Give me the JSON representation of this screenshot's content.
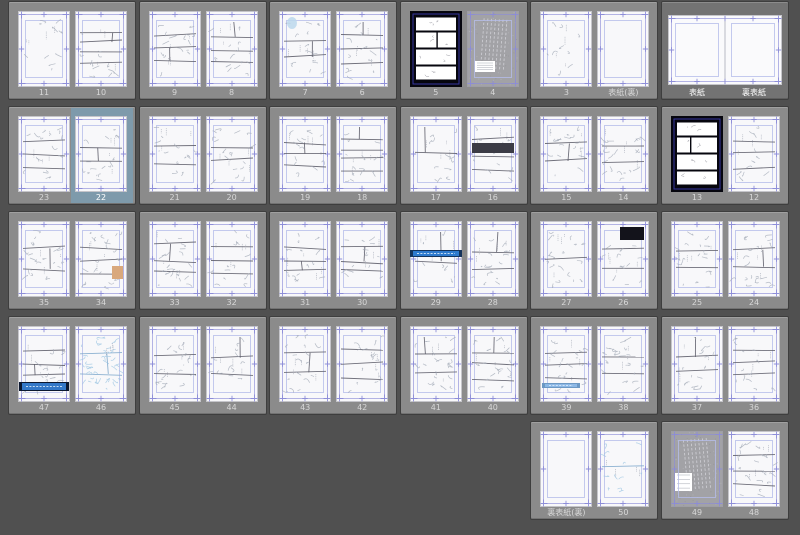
{
  "app": {
    "view_name": "page-manager-thumbnail-grid",
    "selected_page_label": "22",
    "selected_spread_labels": [
      "表紙",
      "裏表紙"
    ]
  },
  "palette": {
    "canvas_bg": "#505050",
    "group_bg": "#8b8b8b",
    "group_selected_bg": "#737373",
    "page_bg": "#f8f8fa",
    "black_page": "#06060e",
    "texture_bg": "#a2a2a6",
    "highlight_blue": "#7e9aab",
    "guide_blue": "#8c8cd8",
    "guide_light": "#b6bdea",
    "guide_dark_blue": "#3b3bb0",
    "sketch_gray": "#a4abb8",
    "sketch_blue": "#9cc6e2",
    "panel_line": "#5f5f6b",
    "label_color": "#d8d8d8",
    "label_selected": "#ffffff"
  },
  "features": {
    "blue-oval": {
      "kind": "ellipse",
      "cx": 13,
      "cy": 12,
      "rx": 5,
      "ry": 6,
      "fill": "#bcd8ec"
    },
    "dark-band": {
      "kind": "rect",
      "x": 5,
      "y": 27,
      "w": 42,
      "h": 10,
      "fill": "#3c3c46"
    },
    "orange-patch": {
      "kind": "rect",
      "x": 37,
      "y": 45,
      "w": 11,
      "h": 13,
      "fill": "#d9a87c"
    },
    "black-panel-tr": {
      "kind": "rect",
      "x": 23,
      "y": 6,
      "w": 24,
      "h": 13,
      "fill": "#13131b"
    },
    "banner-mid-blue": {
      "kind": "bar",
      "x": 0,
      "y": 29,
      "w": 52,
      "h": 7,
      "fill": "#2e7ace",
      "ends": "#14335c"
    },
    "banner-bottom-navy": {
      "kind": "bar",
      "x": 1,
      "y": 56,
      "w": 50,
      "h": 9,
      "fill": "#3478c8",
      "ends": "#0c1830"
    },
    "banner-bottom-light": {
      "kind": "bar",
      "x": 2,
      "y": 57,
      "w": 38,
      "h": 5,
      "fill": "#8cb8e6",
      "ends": "#6c98c4"
    }
  },
  "rows": [
    {
      "start_col": 0,
      "spreads": [
        {
          "pages": [
            {
              "label": "11",
              "type": "sketch",
              "panels": 0,
              "strokes": 10
            },
            {
              "label": "10",
              "type": "sketch",
              "panels": 4
            }
          ]
        },
        {
          "pages": [
            {
              "label": "9",
              "type": "sketch",
              "panels": 3
            },
            {
              "label": "8",
              "type": "sketch",
              "panels": 3
            }
          ]
        },
        {
          "pages": [
            {
              "label": "7",
              "type": "sketch",
              "panels": 2,
              "feature": "blue-oval"
            },
            {
              "label": "6",
              "type": "sketch",
              "panels": 3
            }
          ]
        },
        {
          "pages": [
            {
              "label": "5",
              "type": "black",
              "seed": 5
            },
            {
              "label": "4",
              "type": "texture",
              "seed": 4
            }
          ]
        },
        {
          "pages": [
            {
              "label": "3",
              "type": "sketch",
              "panels": 0,
              "strokes": 9
            },
            {
              "label": "表紙(裏)",
              "type": "blank",
              "seed": 2
            }
          ]
        },
        {
          "joined": true,
          "selected": true,
          "pages": [
            {
              "label": "表紙",
              "type": "blank"
            },
            {
              "label": "裏表紙",
              "type": "blank"
            }
          ]
        }
      ]
    },
    {
      "start_col": 0,
      "spreads": [
        {
          "pages": [
            {
              "label": "23",
              "type": "sketch",
              "panels": 3
            },
            {
              "label": "22",
              "type": "sketch",
              "panels": 2,
              "highlight": true
            }
          ]
        },
        {
          "pages": [
            {
              "label": "21",
              "type": "sketch",
              "panels": 2
            },
            {
              "label": "20",
              "type": "sketch",
              "panels": 2
            }
          ]
        },
        {
          "pages": [
            {
              "label": "19",
              "type": "sketch",
              "panels": 3
            },
            {
              "label": "18",
              "type": "sketch",
              "panels": 4
            }
          ]
        },
        {
          "pages": [
            {
              "label": "17",
              "type": "sketch",
              "panels": 1
            },
            {
              "label": "16",
              "type": "sketch",
              "panels": 3,
              "feature": "dark-band"
            }
          ]
        },
        {
          "pages": [
            {
              "label": "15",
              "type": "sketch",
              "panels": 2
            },
            {
              "label": "14",
              "type": "sketch",
              "panels": 2
            }
          ]
        },
        {
          "pages": [
            {
              "label": "13",
              "type": "black",
              "seed": 13
            },
            {
              "label": "12",
              "type": "sketch",
              "panels": 3
            }
          ]
        }
      ]
    },
    {
      "start_col": 0,
      "spreads": [
        {
          "pages": [
            {
              "label": "35",
              "type": "sketch",
              "panels": 2
            },
            {
              "label": "34",
              "type": "sketch",
              "panels": 3,
              "feature": "orange-patch"
            }
          ]
        },
        {
          "pages": [
            {
              "label": "33",
              "type": "sketch",
              "panels": 3
            },
            {
              "label": "32",
              "type": "sketch",
              "panels": 3
            }
          ]
        },
        {
          "pages": [
            {
              "label": "31",
              "type": "sketch",
              "panels": 3
            },
            {
              "label": "30",
              "type": "sketch",
              "panels": 3
            }
          ]
        },
        {
          "pages": [
            {
              "label": "29",
              "type": "sketch",
              "panels": 1,
              "strokes": 8,
              "feature": "banner-mid-blue"
            },
            {
              "label": "28",
              "type": "sketch",
              "panels": 2
            }
          ]
        },
        {
          "pages": [
            {
              "label": "27",
              "type": "sketch",
              "panels": 1
            },
            {
              "label": "26",
              "type": "sketch",
              "panels": 2,
              "feature": "black-panel-tr"
            }
          ]
        },
        {
          "pages": [
            {
              "label": "25",
              "type": "sketch",
              "panels": 2
            },
            {
              "label": "24",
              "type": "sketch",
              "panels": 2
            }
          ]
        }
      ]
    },
    {
      "start_col": 0,
      "spreads": [
        {
          "pages": [
            {
              "label": "47",
              "type": "sketch",
              "panels": 3,
              "feature": "banner-bottom-navy"
            },
            {
              "label": "46",
              "type": "sketch",
              "panels": 2,
              "tint": "blue",
              "strokes": 42
            }
          ]
        },
        {
          "pages": [
            {
              "label": "45",
              "type": "sketch",
              "panels": 2
            },
            {
              "label": "44",
              "type": "sketch",
              "panels": 2
            }
          ]
        },
        {
          "pages": [
            {
              "label": "43",
              "type": "sketch",
              "panels": 2
            },
            {
              "label": "42",
              "type": "sketch",
              "panels": 3
            }
          ]
        },
        {
          "pages": [
            {
              "label": "41",
              "type": "sketch",
              "panels": 2
            },
            {
              "label": "40",
              "type": "sketch",
              "panels": 3
            }
          ]
        },
        {
          "pages": [
            {
              "label": "39",
              "type": "sketch",
              "panels": 3,
              "feature": "banner-bottom-light"
            },
            {
              "label": "38",
              "type": "sketch",
              "panels": 2
            }
          ]
        },
        {
          "pages": [
            {
              "label": "37",
              "type": "sketch",
              "panels": 2
            },
            {
              "label": "36",
              "type": "sketch",
              "panels": 3
            }
          ]
        }
      ]
    },
    {
      "start_col": 4,
      "spreads": [
        {
          "pages": [
            {
              "label": "裏表紙(裏)",
              "type": "blank",
              "seed": 51
            },
            {
              "label": "50",
              "type": "sketch",
              "panels": 1,
              "tint": "blue",
              "strokes": 12
            }
          ]
        },
        {
          "pages": [
            {
              "label": "49",
              "type": "texture",
              "seed": 49
            },
            {
              "label": "48",
              "type": "sketch",
              "panels": 3
            }
          ]
        }
      ]
    }
  ]
}
